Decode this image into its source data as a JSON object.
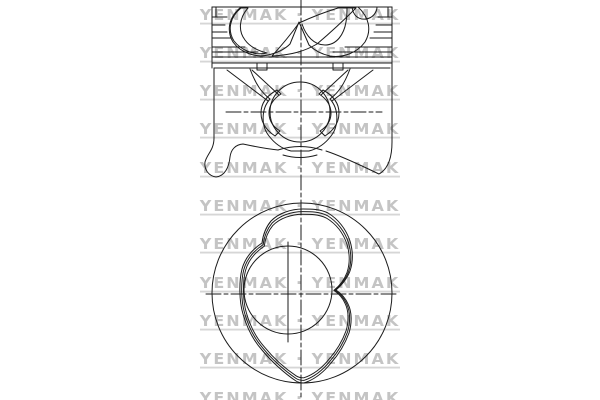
{
  "watermark": {
    "row_text": "YENMAK · YENMAK",
    "word": "YENMAK",
    "separator": "·",
    "row_count": 11,
    "row_pitch_px": 38.3,
    "first_row_center_y_px": 15,
    "color": "#c4c4c4",
    "underline_color": "#d6d6d6"
  },
  "canvas": {
    "background": "#ffffff",
    "line_color": "#1b1b1b"
  }
}
